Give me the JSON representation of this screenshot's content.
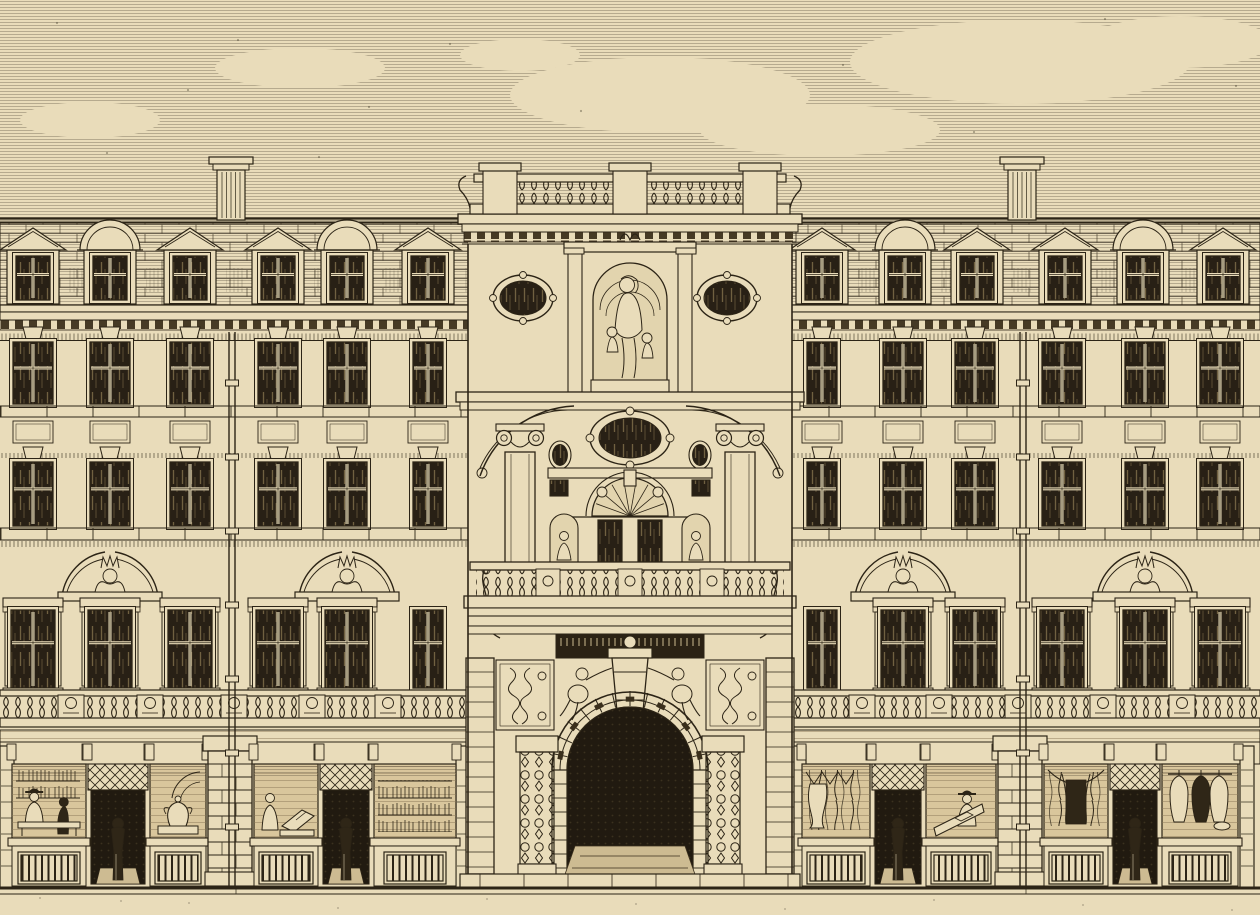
{
  "meta": {
    "type": "engraving",
    "description": "Nineteenth-century sepia line engraving of a grand five-storey building facade: central tower with balustraded top, statue niche of a woman with children, oval oculus windows, broken pediments, columned balcony stage and a deep rusticated entrance arch flanked by cherubs; left and right wings with mansard roof, pedimented and arched dormers, three rows of sash windows, crowned bust pediments, balustraded balcony and ground-floor shopfronts with figures, displays and hanging fabrics.",
    "style": "line engraving on cream paper"
  },
  "palette": {
    "paper": "#e9dcba",
    "paper_dark": "#dcc9a0",
    "ink": "#2c2416",
    "glass": "#282015",
    "interior": "#d9c69c",
    "dark_opening": "#211a10",
    "dark_figure": "#2f2617",
    "floor_light": "#cdbb92",
    "dentil": "#463a25",
    "niche_bg": "#e2d4ae",
    "tick": "#cbb98e"
  },
  "scene": {
    "sky": {
      "hatch_top": 0,
      "hatch_bottom": 335,
      "clouds": [
        [
          660,
          95,
          150,
          38
        ],
        [
          1020,
          62,
          170,
          42
        ],
        [
          820,
          130,
          120,
          26
        ],
        [
          300,
          68,
          85,
          20
        ],
        [
          1180,
          42,
          90,
          26
        ],
        [
          520,
          55,
          60,
          16
        ],
        [
          90,
          120,
          70,
          18
        ]
      ]
    },
    "chimneys": [
      231,
      1022
    ],
    "levels": {
      "ridge": 219,
      "roof_top": 222,
      "eaves": 305,
      "dentils": 320,
      "frieze": 332,
      "rowA_y": 342,
      "rowA_h": 62,
      "sillA": 406,
      "panel_y": 421,
      "rowB_y": 462,
      "rowB_h": 64,
      "sillB": 528,
      "bust_shelf": 596,
      "rowC_y": 610,
      "rowC_h": 78,
      "balustrade_y": 690,
      "shop_entablature": 730,
      "shop_open_y": 764,
      "shop_sill": 838,
      "stall_y": 846,
      "pavement": 888
    },
    "wings": [
      {
        "side": "left",
        "x": 0,
        "w": 470,
        "cols": [
          {
            "x": 33,
            "w": 40
          },
          {
            "x": 110,
            "w": 40
          },
          {
            "x": 190,
            "w": 40
          },
          {
            "x": 278,
            "w": 40
          },
          {
            "x": 347,
            "w": 40
          },
          {
            "x": 428,
            "w": 30,
            "narrow": true
          }
        ],
        "dormers": [
          {
            "x": 33,
            "t": "tri"
          },
          {
            "x": 110,
            "t": "arc"
          },
          {
            "x": 190,
            "t": "tri"
          },
          {
            "x": 278,
            "t": "tri"
          },
          {
            "x": 347,
            "t": "arc"
          },
          {
            "x": 428,
            "t": "tri"
          }
        ],
        "busts": [
          110,
          347
        ],
        "downpipe": 232,
        "balu_panels": [
          71,
          150,
          234,
          312,
          388
        ],
        "pilasters": [
          0,
          456
        ],
        "shop_bays": [
          {
            "type": "display",
            "x": 12,
            "w": 74,
            "contents": "counter"
          },
          {
            "type": "door",
            "x": 88,
            "w": 60,
            "contents": "walking-figure"
          },
          {
            "type": "display",
            "x": 150,
            "w": 56,
            "contents": "urn"
          },
          {
            "type": "pier",
            "x": 208,
            "w": 44
          },
          {
            "type": "display",
            "x": 254,
            "w": 64,
            "contents": "reader"
          },
          {
            "type": "door",
            "x": 320,
            "w": 52,
            "contents": "standing-figure"
          },
          {
            "type": "display",
            "x": 374,
            "w": 82,
            "contents": "books"
          }
        ]
      },
      {
        "side": "right",
        "x": 790,
        "w": 470,
        "cols": [
          {
            "x": 822,
            "w": 30,
            "narrow": true
          },
          {
            "x": 903,
            "w": 40
          },
          {
            "x": 975,
            "w": 40
          },
          {
            "x": 1062,
            "w": 40
          },
          {
            "x": 1145,
            "w": 40
          },
          {
            "x": 1220,
            "w": 40
          }
        ],
        "dormers": [
          {
            "x": 822,
            "t": "tri"
          },
          {
            "x": 905,
            "t": "arc"
          },
          {
            "x": 977,
            "t": "tri"
          },
          {
            "x": 1065,
            "t": "tri"
          },
          {
            "x": 1143,
            "t": "arc"
          },
          {
            "x": 1223,
            "t": "tri"
          }
        ],
        "busts": [
          903,
          1145
        ],
        "downpipe": 1023,
        "balu_panels": [
          862,
          939,
          1018,
          1103,
          1182
        ],
        "pilasters": [
          792,
          1240
        ],
        "shop_bays": [
          {
            "type": "display",
            "x": 802,
            "w": 68,
            "contents": "fabrics"
          },
          {
            "type": "door",
            "x": 872,
            "w": 52,
            "contents": "standing-figure"
          },
          {
            "type": "display",
            "x": 926,
            "w": 70,
            "contents": "desk"
          },
          {
            "type": "pier",
            "x": 998,
            "w": 44
          },
          {
            "type": "display",
            "x": 1044,
            "w": 64,
            "contents": "curtains"
          },
          {
            "type": "door",
            "x": 1110,
            "w": 50,
            "contents": "standing-figure"
          },
          {
            "type": "display",
            "x": 1162,
            "w": 76,
            "contents": "garments"
          }
        ]
      }
    ],
    "tower": {
      "x": 468,
      "w": 324,
      "cx": 630,
      "balustrade_pedestals": [
        500,
        630,
        760
      ],
      "oculi": [
        523,
        727
      ],
      "columns": [
        520,
        740
      ],
      "statue": "woman-with-children",
      "cherubs": [
        578,
        682
      ],
      "small_niche_figures": [
        564,
        696
      ]
    }
  }
}
